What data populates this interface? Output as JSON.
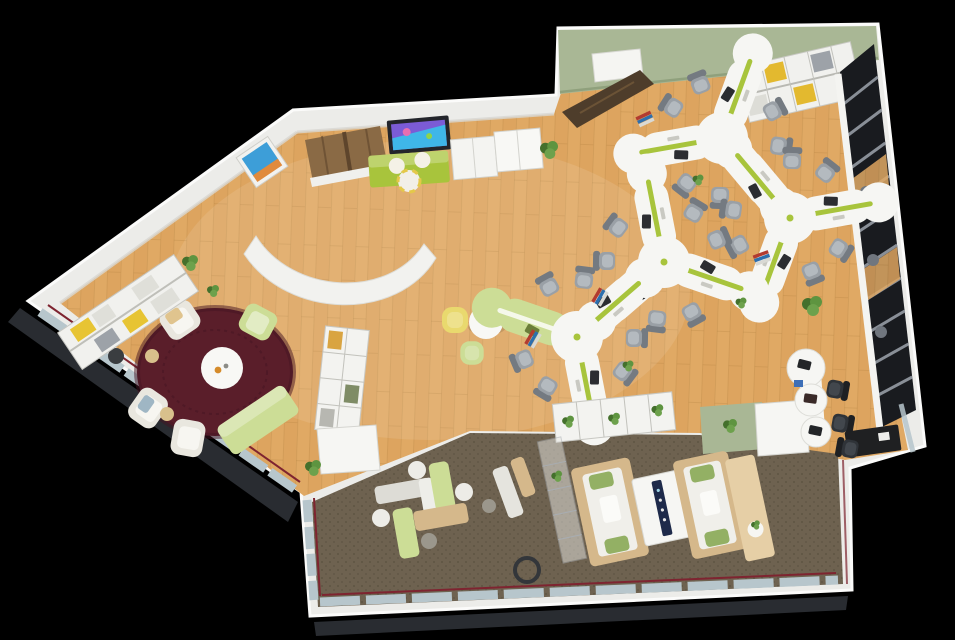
{
  "palette": {
    "background": "#000000",
    "wall": "#ECECE9",
    "wall_edge": "#CFCEC9",
    "wall_shade": "#D9D8D3",
    "wood": "#DDA45F",
    "wood_light": "#F0C684",
    "plank": "#A97B3C",
    "green_wall": "#A9B795",
    "green_wall_dark": "#8FA07C",
    "carpet": "#6E6250",
    "carpet_dot": "#5D5342",
    "rug": "#5A1E2A",
    "rug_dark": "#431421",
    "lime": "#A8C43C",
    "lime_soft": "#CCDD96",
    "yellow": "#E9D96E",
    "white_furniture": "#F6F6F3",
    "white_dim": "#E6E5DF",
    "gray_chair": "#9AA0A6",
    "gray_chair_dark": "#747A81",
    "corridor": "#191B1F",
    "rack": "#969CA4",
    "beige": "#D5B88B",
    "beige_light": "#E6CFA6",
    "cushion": "#F0EFEA",
    "pillow_green": "#93B064",
    "plant": "#5E9440",
    "plant_dark": "#44702C",
    "glass": "#B7C6CC",
    "trim_red": "#7E2430",
    "tv_frame": "#23252B",
    "tv_screen_a": "#7B5BD6",
    "tv_screen_b": "#3FB6E8",
    "art_blue": "#3D9ED8",
    "art_warm": "#E08A3C",
    "dark_desk": "#1F2022",
    "mat": "#8A6A45",
    "mat_dark": "#5E452C",
    "console_strip": "#1E2A4A"
  },
  "scene": {
    "view": "top-down 3D render",
    "areas": [
      "open-office",
      "media-wall",
      "reading-lounge",
      "relax-lounge",
      "storage-corridor",
      "entrance"
    ],
    "counts": {
      "desk_clusters": 4,
      "gray_office_chairs": 24,
      "black_chairs": 3,
      "armchairs": 5,
      "daybeds": 2,
      "round_poufs": 7,
      "plants": 13,
      "windows_walls": 3
    }
  }
}
